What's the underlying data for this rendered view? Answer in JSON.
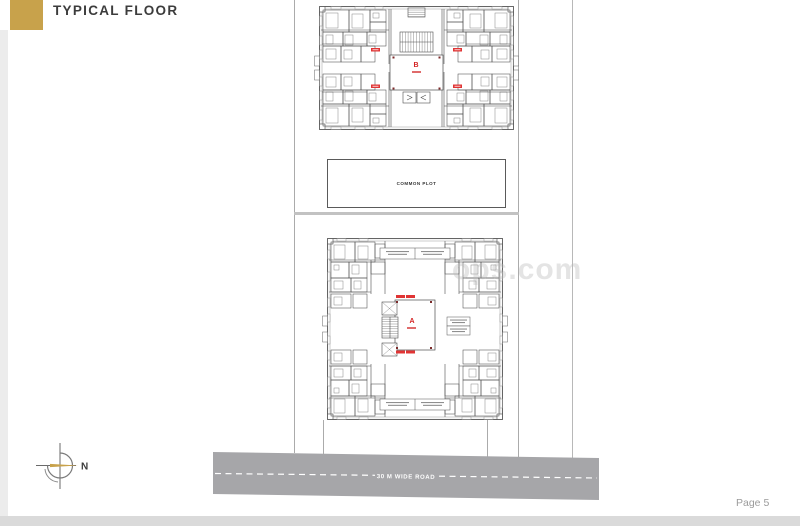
{
  "header": {
    "title": "TYPICAL FLOOR",
    "accent_color": "#c8a24b"
  },
  "site": {
    "common_plot_label": "COMMON PLOT",
    "road_label": "30 M WIDE ROAD",
    "road_color": "#a6a6a9"
  },
  "plans": {
    "building_b": {
      "label": "B"
    },
    "building_a": {
      "label": "A"
    }
  },
  "compass": {
    "north_label": "N",
    "arrow_color": "#c8a24b"
  },
  "watermark": {
    "text": "ops.com"
  },
  "footer": {
    "page_label": "Page 5"
  }
}
